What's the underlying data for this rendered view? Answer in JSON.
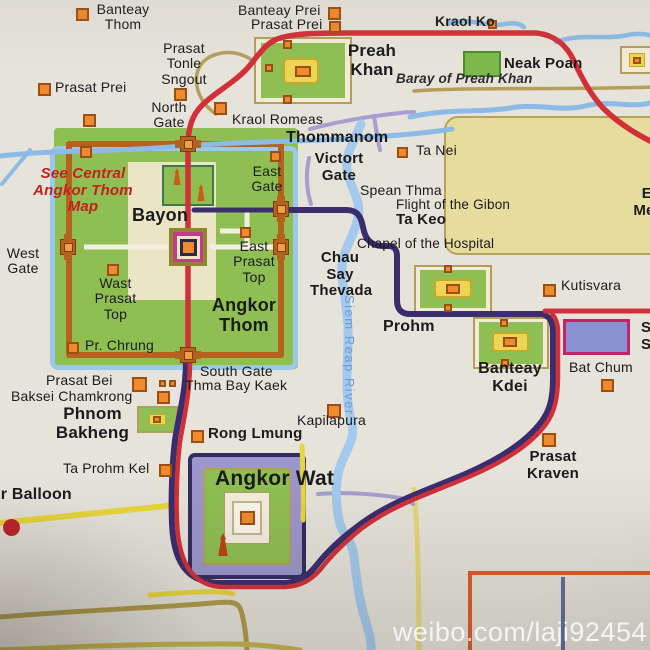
{
  "watermark": "weibo.com/laji92454",
  "colors": {
    "paper": "#e6e3da",
    "temple_green": "#8fbf52",
    "marker_orange": "#ef8a2f",
    "road_red": "#d23038",
    "road_purple": "#3b2c6e",
    "road_yellow": "#e8d63c",
    "road_khaki": "#b09c4a",
    "road_lavender": "#a79ed2",
    "road_wall": "#b5621d",
    "river_blue": "#8cbbe8",
    "baray_beige": "#e6dc9e",
    "srah_srang_fill": "#8b90d2",
    "srah_srang_border": "#c02565",
    "note_red": "#c41f1f"
  },
  "labels": {
    "banteay_thom": "Banteay Thom",
    "prasat_prei_nw": "Prasat Prei",
    "prasat_tonle_sngout": "Prasat Tonle Sngout",
    "north_gate": "North Gate",
    "kraol_romeas": "Kraol Romeas",
    "banteay_prei": "Banteay Prei",
    "prasat_prei_n": "Prasat Prei",
    "preah_khan": "Preah Khan",
    "kraol_ko": "Kraol Ko",
    "neak_poan": "Neak Poan",
    "baray_of_preah_khan": "Baray of Preah Khan",
    "thommanom": "Thommanom",
    "victory_gate": "Victort Gate",
    "ta_nei": "Ta Nei",
    "east_gate": "East Gate",
    "spean_thma": "Spean Thma",
    "flight_of_the_gibon": "Flight of the Gibon",
    "ta_keo": "Ta Keo",
    "chapel_of_the_hospital": "Chapel of the Hospital",
    "chau_say_thevada": "Chau Say Thevada",
    "east_prasat_top": "East Prasat Top",
    "bayon": "Bayon",
    "see_central_note": "See Central Angkor Thom Map",
    "west_gate": "West Gate",
    "wast_prasat_top": "Wast Prasat Top",
    "angkor_thom": "Angkor Thom",
    "pr_chrung": "Pr. Chrung",
    "prohm": "Prohm",
    "kutisvara": "Kutisvara",
    "banteay_kdei": "Banteay Kdei",
    "bat_chum": "Bat Chum",
    "srah_srang": "Srah Srang",
    "south_gate": "South Gate",
    "thma_bay_kaek": "Thma Bay Kaek",
    "prasat_bei": "Prasat Bei",
    "baksei_chamkrong": "Baksei Chamkrong",
    "phnom_bakheng": "Phnom Bakheng",
    "rong_lmung": "Rong Lmung",
    "kapilapura": "Kapilapura",
    "ta_prohm_kel": "Ta Prohm Kel",
    "angkor_balloon": "Angkor Balloon",
    "angkor_wat": "Angkor Wat",
    "prasat_kraven": "Prasat Kraven",
    "east_mebon": "East Mebon",
    "siem_reap_river": "Siem Reap River"
  }
}
